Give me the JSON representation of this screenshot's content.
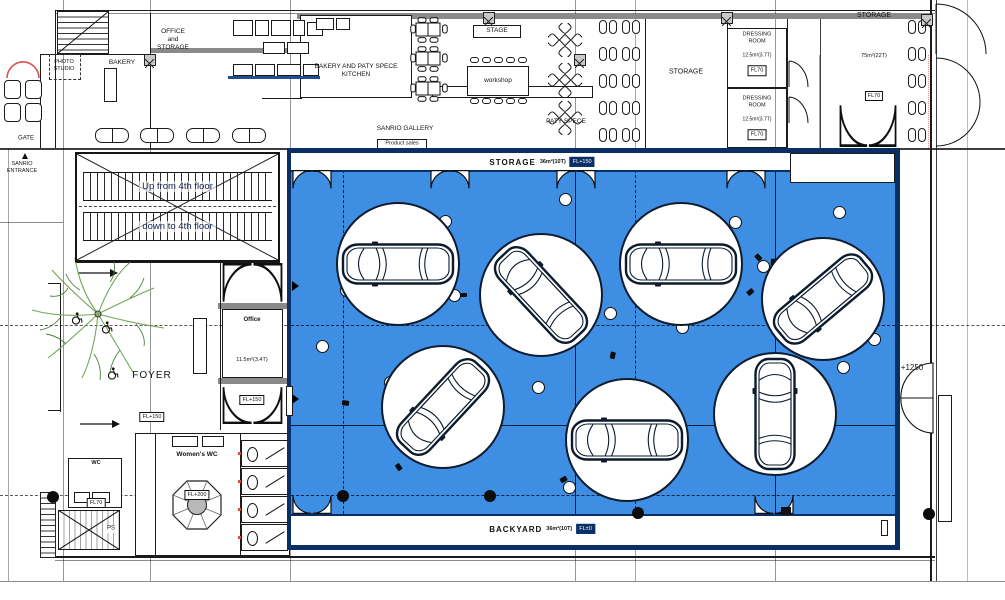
{
  "palette": {
    "blue": "#3e8ee4",
    "navy": "#0a2f66",
    "pink": "#ef8b7d",
    "red_door": "#d9534f",
    "wall": "#1b1b1b"
  },
  "rooms": {
    "office_storage": "OFFICE\nand\nSTORAGE",
    "bakery": "BAKERY",
    "photo_studio": "PHOTO\nSTUDIO",
    "gate": "GATE",
    "sanrio_entrance": "SANRIO\nENTRANCE",
    "kitchen": "BAKERY AND PATY SPECE\nKITCHEN",
    "stage": "STAGE",
    "workshop": "workshop",
    "paty_spece": "PATY SPECE",
    "sanrio_gallery": "SANRIO GALLERY",
    "product_sales": "Product sales",
    "storage_mid": "STORAGE",
    "dressing_rooms": [
      {
        "name": "DRESSING\nROOM",
        "area": "12.5m²(3.7T)",
        "level": "FL70"
      },
      {
        "name": "DRESSING\nROOM",
        "area": "12.5m²(3.7T)",
        "level": "FL70"
      }
    ],
    "storage_right": {
      "name": "STORAGE",
      "area": "75m²(22T)",
      "level": "FL70"
    },
    "escalator_up": "Up from 4th floor",
    "escalator_down": "down to 4th floor",
    "foyer": {
      "name": "FOYER",
      "level": "FL+150"
    },
    "office_small": {
      "name": "Office",
      "area": "11.5m²(3.4T)",
      "level": "FL+150"
    },
    "womens_wc": {
      "name": "Women's WC",
      "level": "FL+200"
    },
    "accessible_wc": {
      "name": "WC",
      "level": "FL70"
    },
    "ps": "PS",
    "level_marker": "+1250"
  },
  "showroom": {
    "storage_strip": {
      "name": "STORAGE",
      "area": "36m²(10T)",
      "level": "FL+150"
    },
    "backyard_strip": {
      "name": "BACKYARD",
      "area": "36m²(10T)",
      "level": "FL±0"
    },
    "turntables": [
      {
        "x": 398,
        "y": 264,
        "r": 62,
        "rot": 0
      },
      {
        "x": 541,
        "y": 295,
        "r": 62,
        "rot": 47
      },
      {
        "x": 681,
        "y": 264,
        "r": 62,
        "rot": 0
      },
      {
        "x": 823,
        "y": 299,
        "r": 62,
        "rot": -40
      },
      {
        "x": 443,
        "y": 407,
        "r": 62,
        "rot": -47
      },
      {
        "x": 627,
        "y": 440,
        "r": 62,
        "rot": 0
      },
      {
        "x": 775,
        "y": 414,
        "r": 62,
        "rot": 90
      }
    ],
    "white_dots": [
      [
        445,
        221
      ],
      [
        346,
        290
      ],
      [
        454,
        295
      ],
      [
        322,
        346
      ],
      [
        565,
        199
      ],
      [
        735,
        222
      ],
      [
        839,
        212
      ],
      [
        763,
        266
      ],
      [
        610,
        313
      ],
      [
        682,
        327
      ],
      [
        874,
        339
      ],
      [
        843,
        367
      ],
      [
        390,
        382
      ],
      [
        538,
        387
      ],
      [
        569,
        487
      ],
      [
        791,
        464
      ]
    ],
    "black_dots": [
      [
        343,
        496
      ],
      [
        490,
        496
      ],
      [
        638,
        513
      ]
    ],
    "spotlights": [
      [
        463,
        295
      ],
      [
        758,
        257
      ],
      [
        773,
        262
      ],
      [
        750,
        292
      ],
      [
        345,
        403
      ],
      [
        398,
        467
      ],
      [
        612,
        355
      ],
      [
        563,
        479
      ]
    ],
    "doors_top": [
      312,
      450,
      576,
      746
    ],
    "doors_bottom": [
      312,
      774
    ]
  },
  "furniture": {
    "equipment_boxes": [
      [
        233,
        20,
        20,
        16
      ],
      [
        255,
        20,
        14,
        16
      ],
      [
        271,
        20,
        20,
        16
      ],
      [
        293,
        20,
        12,
        16
      ],
      [
        307,
        22,
        16,
        14
      ],
      [
        263,
        42,
        22,
        12
      ],
      [
        287,
        42,
        22,
        12
      ],
      [
        233,
        64,
        20,
        12
      ],
      [
        255,
        64,
        20,
        12
      ],
      [
        277,
        64,
        24,
        12
      ],
      [
        303,
        64,
        16,
        12
      ],
      [
        316,
        18,
        18,
        12
      ],
      [
        336,
        18,
        14,
        12
      ]
    ],
    "dining_clusters": [
      [
        410,
        17
      ],
      [
        410,
        46
      ],
      [
        410,
        76
      ]
    ],
    "x_tables": [
      [
        548,
        23
      ],
      [
        548,
        63
      ],
      [
        548,
        101
      ]
    ],
    "booth_xs": [
      599,
      622,
      908
    ],
    "booth_ys": [
      20,
      47,
      74,
      101,
      128
    ],
    "benches": [
      [
        95,
        128
      ],
      [
        140,
        128
      ],
      [
        186,
        128
      ],
      [
        232,
        128
      ]
    ],
    "lounge_chairs": [
      [
        4,
        80
      ],
      [
        4,
        103
      ]
    ],
    "stall_ys": [
      440,
      468,
      496,
      524
    ],
    "columns": [
      [
        144,
        54
      ],
      [
        574,
        54
      ],
      [
        483,
        12
      ],
      [
        721,
        12
      ],
      [
        921,
        14
      ]
    ],
    "wheelchairs": [
      [
        72,
        312
      ],
      [
        102,
        321
      ],
      [
        108,
        367
      ]
    ],
    "grid_bullets": [
      [
        53,
        497
      ],
      [
        929,
        514
      ]
    ]
  }
}
